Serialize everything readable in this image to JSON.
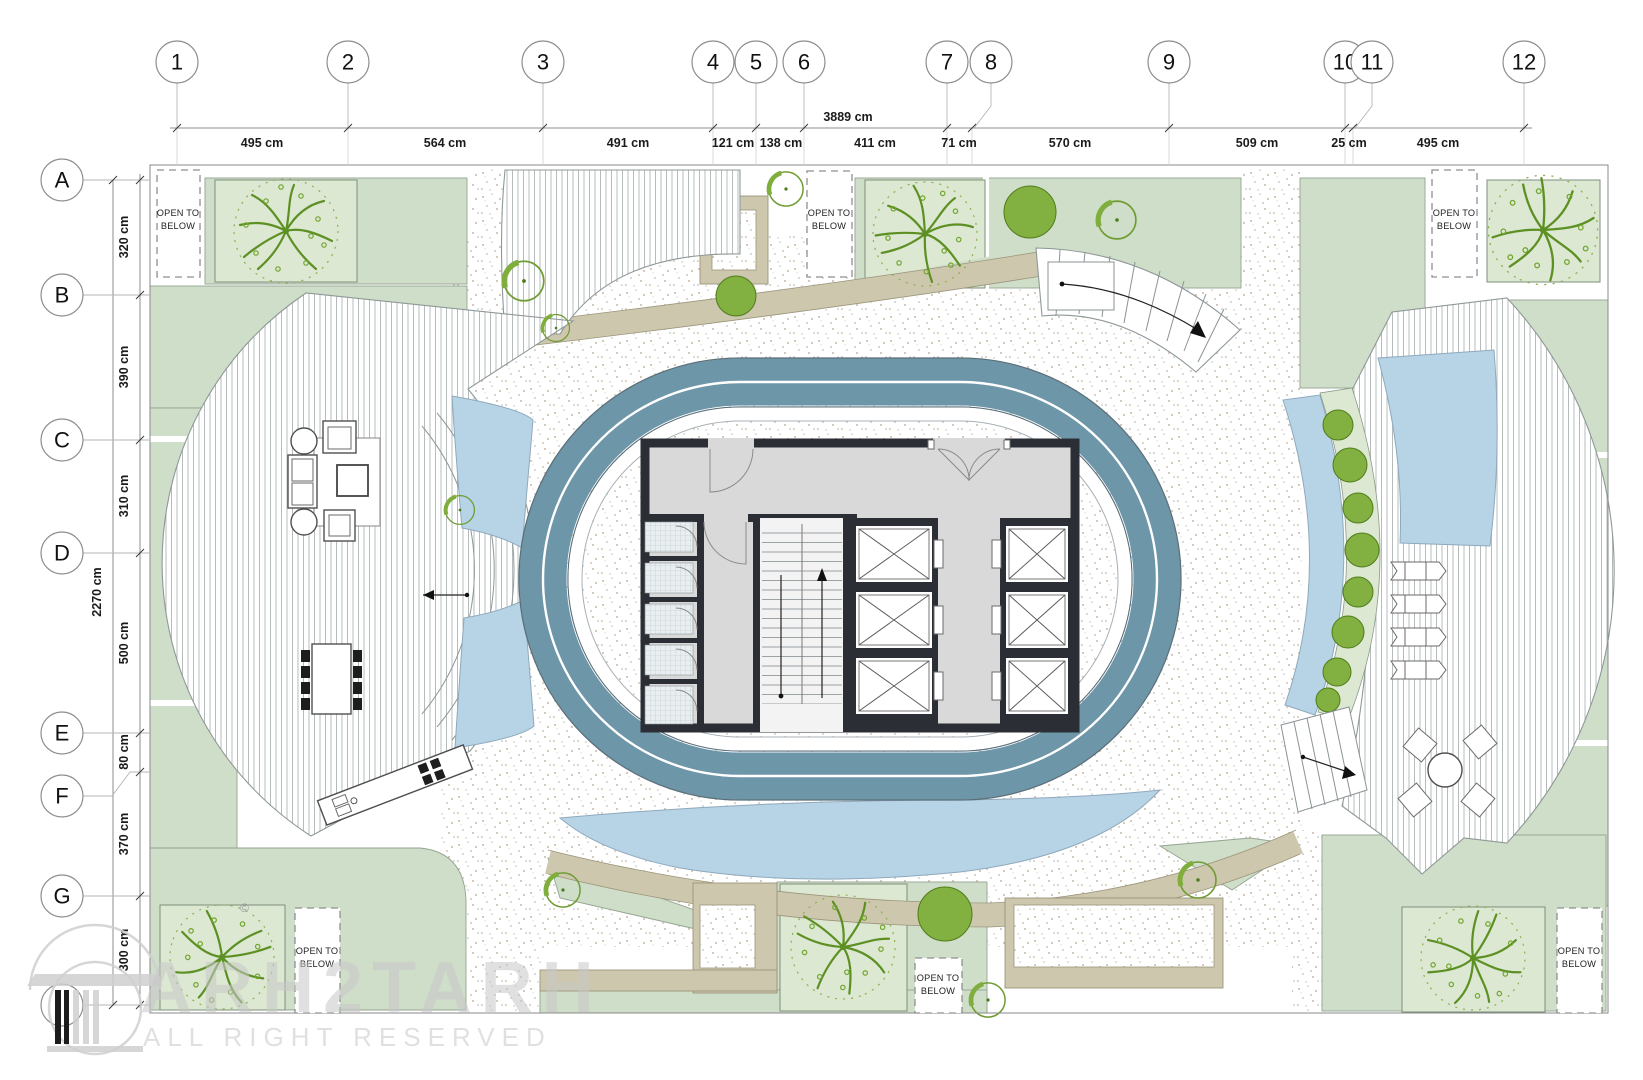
{
  "grid": {
    "columns": [
      "1",
      "2",
      "3",
      "4",
      "5",
      "6",
      "7",
      "8",
      "9",
      "10",
      "11",
      "12"
    ],
    "rows": [
      "A",
      "B",
      "C",
      "D",
      "E",
      "F",
      "G",
      ""
    ]
  },
  "dimensions": {
    "total_width": "3889 cm",
    "top": [
      "495 cm",
      "564 cm",
      "491 cm",
      "121 cm",
      "138 cm",
      "411 cm",
      "71 cm",
      "570 cm",
      "509 cm",
      "25 cm",
      "495 cm"
    ],
    "total_height": "2270 cm",
    "left": [
      "320 cm",
      "390 cm",
      "310 cm",
      "500 cm",
      "80 cm",
      "370 cm",
      "300 cm"
    ]
  },
  "labels": {
    "open_to_below": {
      "line1": "OPEN TO",
      "line2": "BELOW"
    }
  },
  "watermark": {
    "brand": "ARH2TARH",
    "tagline": "ALL RIGHT RESERVED",
    "copyright": "©"
  },
  "colors": {
    "track_blue": "#6d96a9",
    "pool_blue": "#b7d3e6",
    "lawn_green": "#cfdec8",
    "planter_green": "#dce8d2",
    "tree_green": "#5d9023",
    "path_tan": "#cdc7ad",
    "core_wall": "#2b2e35",
    "core_floor": "#d9d9d9"
  }
}
